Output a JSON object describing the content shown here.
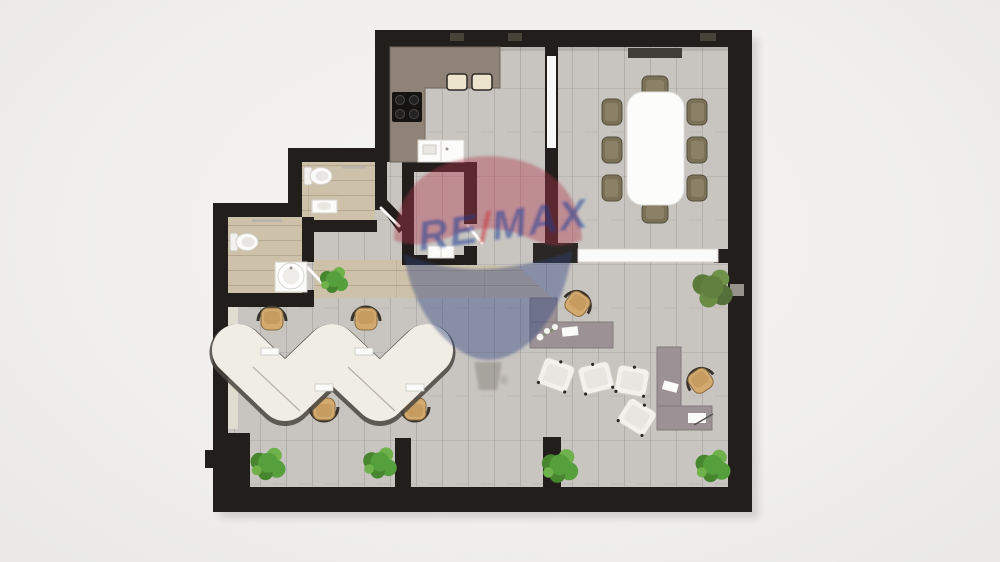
{
  "page": {
    "background": "#f1f0ee",
    "kind": "3d-top-down-floor-plan-render"
  },
  "watermark": {
    "re": "RE",
    "slash": "/",
    "max": "MAX",
    "registered": "®"
  },
  "palette": {
    "wall": "#211e1b",
    "floor_main": "#c8c5c1",
    "floor_beige": "#cdc1a9",
    "counter": "#8f8377",
    "desk_white": "#f0ede5",
    "desk_wood": "#9c9296",
    "chair_tan": "#d2a96e",
    "chair_olive": "#7b7157",
    "plant_green": "#55a03c",
    "balloon_red": "#b0374a",
    "balloon_blue": "#32447c",
    "text_blue": "#1c3c96",
    "slash_red": "#cf3339"
  },
  "elements": {
    "rooms": [
      "conference-room",
      "kitchen",
      "bathroom-upper",
      "bathroom-lower",
      "storage-room",
      "entry-corridor",
      "open-plan-office"
    ],
    "furniture": [
      {
        "name": "conference-table",
        "count": 1
      },
      {
        "name": "conference-chair",
        "count": 8
      },
      {
        "name": "media-board",
        "count": 1
      },
      {
        "name": "kitchen-counter",
        "count": 1
      },
      {
        "name": "cooktop",
        "count": 1
      },
      {
        "name": "bar-stool",
        "count": 2
      },
      {
        "name": "kitchen-sink-unit",
        "count": 1
      },
      {
        "name": "toilet",
        "count": 2
      },
      {
        "name": "washbasin",
        "count": 2
      },
      {
        "name": "wave-desk",
        "count": 1
      },
      {
        "name": "task-chair",
        "count": 6
      },
      {
        "name": "l-shaped-desk",
        "count": 2
      },
      {
        "name": "lounge-chair",
        "count": 4
      },
      {
        "name": "sideboard",
        "count": 2
      },
      {
        "name": "plant",
        "count": 7
      }
    ]
  }
}
